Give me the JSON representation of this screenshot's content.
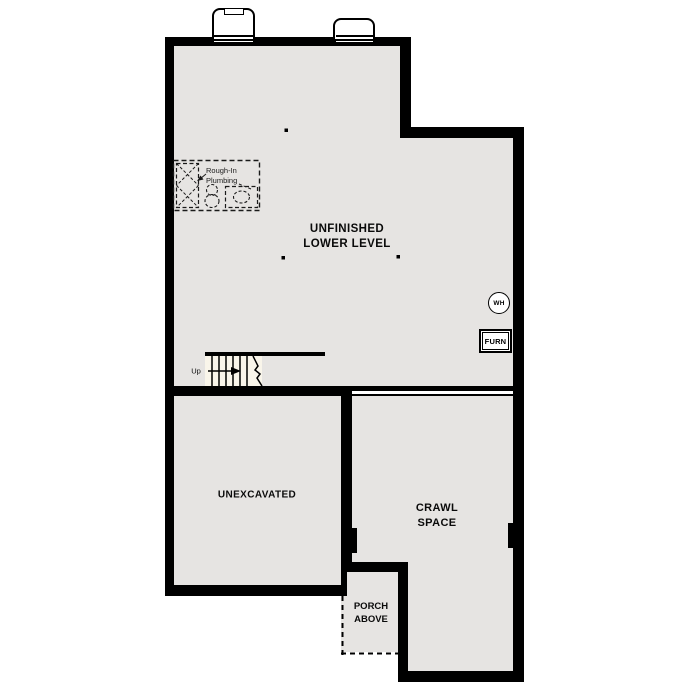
{
  "floorplan": {
    "rooms": {
      "lower_level": {
        "label": "UNFINISHED\nLOWER LEVEL"
      },
      "unexcavated": {
        "label": "UNEXCAVATED"
      },
      "crawl_space": {
        "label": "CRAWL\nSPACE"
      },
      "porch": {
        "label": "PORCH\nABOVE"
      }
    },
    "annotations": {
      "rough_in_plumbing": {
        "label": "Rough-In\nPlumbing"
      },
      "stairs": {
        "direction_label": "Up"
      }
    },
    "equipment": {
      "water_heater": {
        "label": "WH"
      },
      "furnace": {
        "label": "FURN"
      }
    },
    "colors": {
      "wall": "#000000",
      "interior": "#e6e4e2",
      "background": "#ffffff",
      "stair_fill": "#f9f5ea",
      "line": "#1a1a1a"
    }
  }
}
